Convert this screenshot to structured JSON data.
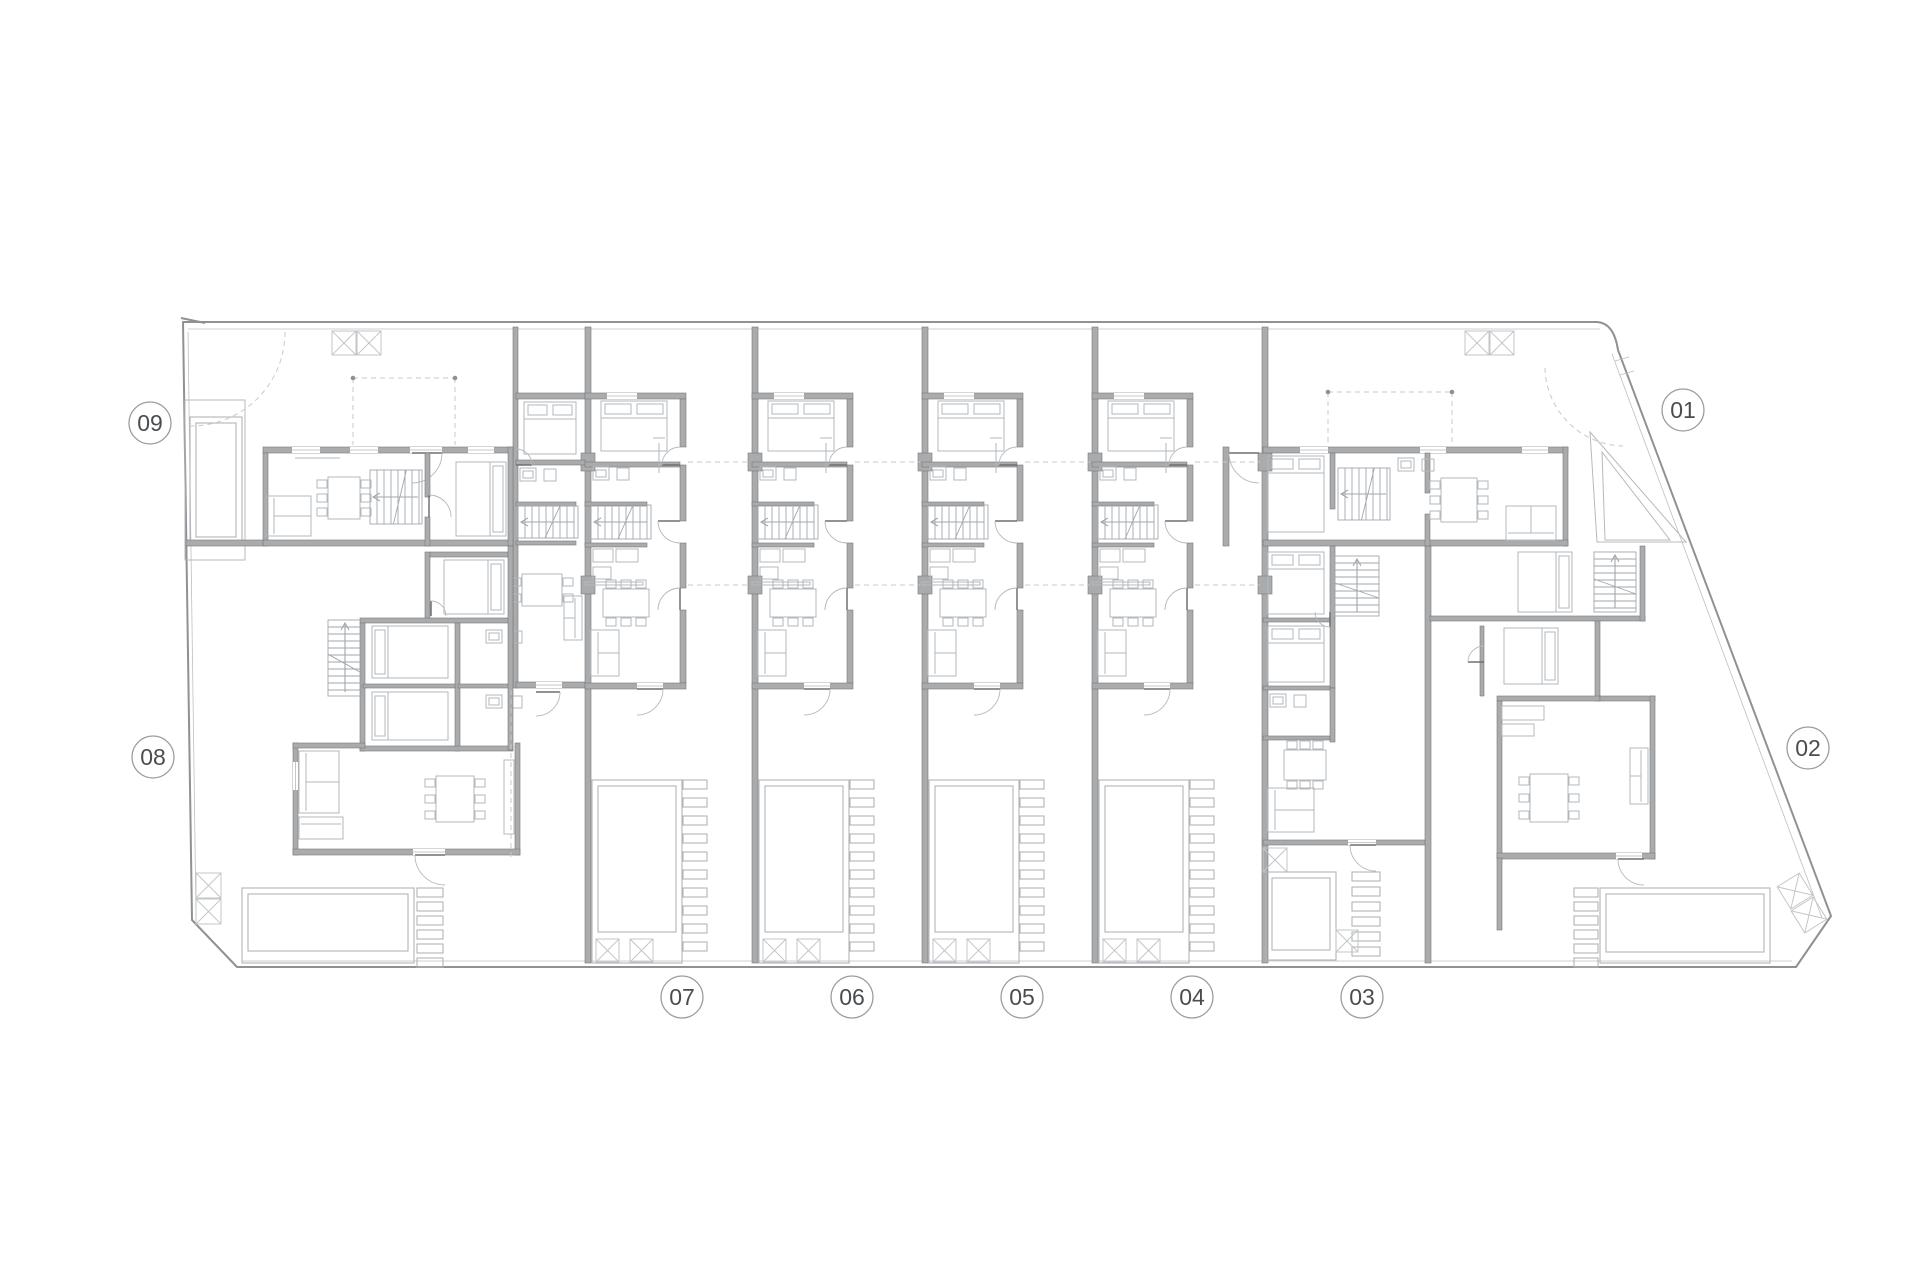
{
  "meta": {
    "sheet_name": "residential-site-floor-plan"
  },
  "colors": {
    "bg": "#ffffff",
    "wall_fill": "#a9abad",
    "wall_stroke": "#77797b",
    "thin": "#b6b9bc",
    "furn": "#b3b8bd",
    "stair": "#a2a7ac",
    "pool": "#b0b4b8",
    "xbox": "#c3c6c9",
    "boundary": "#8f9194",
    "boundary_inner": "#bcbfc2",
    "dash": "#c6c9cc",
    "door_leaf": "#6d7073",
    "label_ring": "#9a9da0",
    "label_text": "#4a4d50"
  },
  "canvas": {
    "w": 1920,
    "h": 1280
  },
  "unit_labels": [
    {
      "text": "09",
      "x": 150,
      "y": 423
    },
    {
      "text": "08",
      "x": 153,
      "y": 757
    },
    {
      "text": "07",
      "x": 682,
      "y": 997
    },
    {
      "text": "06",
      "x": 852,
      "y": 997
    },
    {
      "text": "05",
      "x": 1022,
      "y": 997
    },
    {
      "text": "04",
      "x": 1192,
      "y": 997
    },
    {
      "text": "03",
      "x": 1362,
      "y": 997
    },
    {
      "text": "02",
      "x": 1808,
      "y": 748
    },
    {
      "text": "01",
      "x": 1683,
      "y": 410
    }
  ],
  "boundary": {
    "main": "M183,322 L1597,322 Q1614,323 1618,350 L1831,916 L1796,967 L237,967 L192,920 Z",
    "inner": [
      [
        188,
        329,
        1600,
        329
      ],
      [
        1612,
        354,
        1822,
        918
      ],
      [
        242,
        961,
        1792,
        961
      ],
      [
        188,
        332,
        196,
        916
      ]
    ],
    "hook": "M181,318 l24,5",
    "gate_ticks": [
      [
        1615,
        361,
        1629,
        357
      ],
      [
        1620,
        375,
        1634,
        371
      ]
    ]
  },
  "global_elements": [
    [
      "wall",
      513,
      327,
      5,
      361
    ],
    [
      "wall",
      585,
      327,
      6,
      636
    ],
    [
      "wall",
      752,
      327,
      6,
      636
    ],
    [
      "wall",
      922,
      327,
      6,
      636
    ],
    [
      "wall",
      1092,
      327,
      6,
      636
    ],
    [
      "wall",
      1262,
      327,
      6,
      636
    ],
    [
      "wall",
      1425,
      546,
      6,
      417
    ],
    [
      "wall",
      581,
      453,
      14,
      18
    ],
    [
      "wall",
      581,
      576,
      14,
      18
    ],
    [
      "wall",
      748,
      453,
      14,
      18
    ],
    [
      "wall",
      748,
      576,
      14,
      18
    ],
    [
      "wall",
      918,
      453,
      14,
      18
    ],
    [
      "wall",
      918,
      576,
      14,
      18
    ],
    [
      "wall",
      1088,
      453,
      14,
      18
    ],
    [
      "wall",
      1088,
      576,
      14,
      18
    ],
    [
      "wall",
      1258,
      453,
      14,
      18
    ],
    [
      "wall",
      1258,
      576,
      14,
      18
    ],
    [
      "xbox",
      332,
      331,
      24,
      0
    ],
    [
      "xbox",
      357,
      331,
      24,
      0
    ],
    [
      "xbox",
      1465,
      331,
      24,
      0
    ],
    [
      "xbox",
      1490,
      331,
      24,
      0
    ],
    [
      "twall",
      185,
      400,
      60,
      160
    ],
    [
      "pool",
      190,
      417,
      52,
      126,
      6
    ],
    [
      "wall",
      263,
      447,
      250,
      6
    ],
    [
      "gap",
      292,
      447,
      28,
      6
    ],
    [
      "gap",
      350,
      447,
      28,
      6
    ],
    [
      "gap",
      468,
      447,
      26,
      6
    ],
    [
      "gap",
      410,
      447,
      32,
      6
    ],
    [
      "door",
      412,
      453,
      30,
      0,
      90
    ],
    [
      "wall",
      263,
      453,
      5,
      93
    ],
    [
      "wall",
      263,
      540,
      250,
      6
    ],
    [
      "wall",
      508,
      447,
      5,
      99
    ],
    [
      "wall",
      425,
      453,
      5,
      44
    ],
    [
      "wall",
      425,
      517,
      5,
      29
    ],
    [
      "door",
      429,
      517,
      22,
      270,
      0
    ],
    [
      "stairs",
      370,
      470,
      52,
      54,
      "h"
    ],
    [
      "sofa",
      267,
      496,
      44,
      40,
      "l"
    ],
    [
      "table",
      328,
      477,
      32,
      42,
      "v"
    ],
    [
      "bed",
      456,
      462,
      50,
      74,
      "r"
    ],
    [
      "line",
      295,
      458,
      340,
      458
    ],
    [
      "wall",
      516,
      393,
      69,
      6
    ],
    [
      "wall",
      516,
      460,
      69,
      5
    ],
    [
      "wall",
      516,
      502,
      60,
      4
    ],
    [
      "wall",
      516,
      541,
      60,
      4
    ],
    [
      "wall",
      516,
      682,
      69,
      6
    ],
    [
      "gap",
      536,
      682,
      26,
      6
    ],
    [
      "bed",
      524,
      402,
      52,
      52,
      "t"
    ],
    [
      "bath",
      520,
      468
    ],
    [
      "stairs",
      518,
      506,
      60,
      32,
      "h"
    ],
    [
      "table",
      522,
      574,
      40,
      32,
      "v"
    ],
    [
      "sofa",
      564,
      596,
      18,
      44,
      "r"
    ],
    [
      "door",
      536,
      692,
      24,
      0,
      90
    ],
    [
      "door",
      516,
      465,
      16,
      0,
      270
    ],
    [
      "wall",
      425,
      552,
      5,
      68
    ],
    [
      "wall",
      430,
      552,
      78,
      5
    ],
    [
      "bed",
      444,
      560,
      60,
      54,
      "r"
    ],
    [
      "wall",
      360,
      618,
      153,
      5
    ],
    [
      "wall",
      360,
      623,
      5,
      128
    ],
    [
      "wall",
      455,
      623,
      5,
      128
    ],
    [
      "wall",
      363,
      684,
      92,
      4
    ],
    [
      "wall",
      458,
      684,
      55,
      4
    ],
    [
      "wall",
      360,
      746,
      153,
      5
    ],
    [
      "bed",
      372,
      626,
      76,
      52,
      "l"
    ],
    [
      "bed",
      372,
      692,
      76,
      48,
      "l"
    ],
    [
      "bath",
      486,
      630
    ],
    [
      "bath",
      486,
      695
    ],
    [
      "stairs",
      328,
      620,
      34,
      76,
      "v"
    ],
    [
      "wall",
      508,
      546,
      5,
      204
    ],
    [
      "door",
      431,
      616,
      15,
      270,
      0
    ],
    [
      "wall",
      293,
      743,
      5,
      112
    ],
    [
      "wall",
      293,
      743,
      72,
      5
    ],
    [
      "wall",
      515,
      743,
      5,
      112
    ],
    [
      "wall",
      293,
      849,
      227,
      6
    ],
    [
      "gap",
      413,
      849,
      32,
      6
    ],
    [
      "door",
      445,
      855,
      30,
      180,
      90
    ],
    [
      "gap",
      293,
      762,
      5,
      28
    ],
    [
      "sofa",
      299,
      751,
      40,
      62,
      "l"
    ],
    [
      "sofa",
      299,
      817,
      44,
      22,
      "t"
    ],
    [
      "table",
      436,
      776,
      38,
      46,
      "v"
    ],
    [
      "twall",
      504,
      760,
      10,
      74
    ],
    [
      "wall",
      186,
      540,
      77,
      6
    ],
    [
      "pool",
      242,
      888,
      172,
      75,
      12
    ],
    [
      "stones",
      417,
      888,
      6,
      14,
      26,
      9
    ],
    [
      "xbox",
      196,
      873,
      25,
      0
    ],
    [
      "xbox",
      196,
      899,
      25,
      0
    ],
    [
      "dline",
      511,
      690,
      511,
      858
    ],
    [
      "wall",
      1263,
      447,
      305,
      6
    ],
    [
      "gap",
      1300,
      447,
      28,
      6
    ],
    [
      "gap",
      1420,
      447,
      26,
      6
    ],
    [
      "gap",
      1522,
      447,
      26,
      6
    ],
    [
      "wall",
      1223,
      447,
      6,
      99
    ],
    [
      "door",
      1259,
      453,
      30,
      180,
      90
    ],
    [
      "wall",
      1563,
      447,
      5,
      99
    ],
    [
      "wall",
      1263,
      540,
      305,
      6
    ],
    [
      "wall",
      1330,
      453,
      5,
      56
    ],
    [
      "wall",
      1425,
      453,
      5,
      40
    ],
    [
      "wall",
      1425,
      514,
      5,
      32
    ],
    [
      "bed",
      1268,
      456,
      56,
      76,
      "t"
    ],
    [
      "stairs",
      1338,
      468,
      52,
      52,
      "h"
    ],
    [
      "bath",
      1398,
      458
    ],
    [
      "table",
      1441,
      478,
      36,
      44,
      "v"
    ],
    [
      "sofa",
      1506,
      506,
      50,
      34,
      "b"
    ],
    [
      "path",
      "M1590,432 L1686,542 L1597,542 Z",
      "twall"
    ],
    [
      "path",
      "M1602,452 L1670,540 L1605,540 Z",
      "twall"
    ],
    [
      "wall",
      1330,
      546,
      5,
      142
    ],
    [
      "bed",
      1268,
      552,
      56,
      62,
      "t"
    ],
    [
      "wall",
      1263,
      618,
      67,
      4
    ],
    [
      "bed",
      1268,
      626,
      56,
      56,
      "t"
    ],
    [
      "wall",
      1263,
      686,
      67,
      4
    ],
    [
      "bath",
      1270,
      694
    ],
    [
      "wall",
      1263,
      736,
      67,
      4
    ],
    [
      "stairs",
      1335,
      556,
      44,
      60,
      "v"
    ],
    [
      "door",
      1330,
      612,
      15,
      90,
      180
    ],
    [
      "wall",
      1330,
      688,
      5,
      54
    ],
    [
      "table",
      1284,
      750,
      42,
      30,
      "h"
    ],
    [
      "sofa",
      1268,
      788,
      46,
      44,
      "l"
    ],
    [
      "wall",
      1263,
      840,
      162,
      5
    ],
    [
      "gap",
      1348,
      840,
      28,
      5
    ],
    [
      "door",
      1376,
      845,
      26,
      180,
      90
    ],
    [
      "xbox",
      1263,
      848,
      24,
      0
    ],
    [
      "pool",
      1266,
      872,
      70,
      88,
      10
    ],
    [
      "stones",
      1352,
      872,
      6,
      15,
      28,
      9
    ],
    [
      "xbox",
      1336,
      930,
      22,
      0
    ],
    [
      "wall",
      1430,
      616,
      215,
      5
    ],
    [
      "wall",
      1640,
      546,
      5,
      75
    ],
    [
      "bed",
      1518,
      552,
      54,
      60,
      "r"
    ],
    [
      "stairs",
      1594,
      552,
      42,
      60,
      "v"
    ],
    [
      "wall",
      1595,
      621,
      5,
      80
    ],
    [
      "bed",
      1504,
      628,
      54,
      56,
      "r"
    ],
    [
      "wall",
      1480,
      626,
      4,
      70
    ],
    [
      "door",
      1484,
      662,
      16,
      180,
      270
    ],
    [
      "wall",
      1497,
      696,
      103,
      5
    ],
    [
      "wall",
      1600,
      696,
      55,
      5
    ],
    [
      "wall",
      1497,
      701,
      5,
      157
    ],
    [
      "wall",
      1650,
      696,
      5,
      163
    ],
    [
      "wall",
      1497,
      853,
      158,
      6
    ],
    [
      "gap",
      1616,
      853,
      26,
      6
    ],
    [
      "door",
      1644,
      859,
      26,
      180,
      90
    ],
    [
      "table",
      1530,
      774,
      38,
      48,
      "v"
    ],
    [
      "sofa",
      1630,
      748,
      18,
      56,
      "r"
    ],
    [
      "twall",
      1502,
      706,
      42,
      14
    ],
    [
      "twall",
      1502,
      724,
      32,
      12
    ],
    [
      "wall",
      1497,
      858,
      5,
      72
    ],
    [
      "pool",
      1600,
      888,
      170,
      75,
      11
    ],
    [
      "stones",
      1574,
      888,
      6,
      14,
      24,
      9
    ],
    [
      "xbox",
      1782,
      878,
      26,
      -32
    ],
    [
      "xbox",
      1796,
      902,
      26,
      -32
    ],
    [
      "dline",
      688,
      462,
      750,
      462
    ],
    [
      "dline",
      688,
      585,
      750,
      585
    ],
    [
      "dline",
      855,
      462,
      920,
      462
    ],
    [
      "dline",
      855,
      585,
      920,
      585
    ],
    [
      "dline",
      1025,
      462,
      1090,
      462
    ],
    [
      "dline",
      1025,
      585,
      1090,
      585
    ],
    [
      "dline",
      1195,
      462,
      1260,
      462
    ],
    [
      "dline",
      1195,
      585,
      1260,
      585
    ],
    [
      "dline",
      353,
      378,
      455,
      378
    ],
    [
      "dline",
      353,
      378,
      353,
      445
    ],
    [
      "dline",
      455,
      378,
      455,
      445
    ],
    [
      "dot",
      353,
      378
    ],
    [
      "dot",
      455,
      378
    ],
    [
      "dline",
      1328,
      392,
      1452,
      392
    ],
    [
      "dline",
      1328,
      392,
      1328,
      445
    ],
    [
      "dline",
      1452,
      392,
      1452,
      445
    ],
    [
      "dot",
      1328,
      392
    ],
    [
      "dot",
      1452,
      392
    ],
    [
      "dpath",
      "M285,332 A94,94 0 0 1 191,426"
    ],
    [
      "dpath",
      "M1545,368 A80,80 0 0 0 1623,446"
    ]
  ],
  "townhouse": {
    "lefts": [
      585,
      752,
      922,
      1092
    ],
    "top": 327,
    "elements": [
      [
        "wall",
        0,
        66,
        101,
        6
      ],
      [
        "gap",
        22,
        66,
        30,
        6
      ],
      [
        "wall",
        95,
        72,
        6,
        48
      ],
      [
        "wall",
        95,
        138,
        6,
        56
      ],
      [
        "wall",
        95,
        216,
        6,
        45
      ],
      [
        "wall",
        95,
        283,
        6,
        73
      ],
      [
        "wall",
        0,
        135,
        95,
        5
      ],
      [
        "wall",
        0,
        175,
        62,
        4
      ],
      [
        "wall",
        0,
        216,
        62,
        4
      ],
      [
        "twall",
        0,
        255,
        58,
        3
      ],
      [
        "wall",
        0,
        356,
        101,
        6
      ],
      [
        "gap",
        52,
        356,
        26,
        6
      ],
      [
        "bed",
        16,
        74,
        66,
        50,
        "t"
      ],
      [
        "bath",
        8,
        140
      ],
      [
        "line",
        74,
        116,
        74,
        146
      ],
      [
        "line",
        68,
        111,
        80,
        111
      ],
      [
        "stairs",
        6,
        178,
        60,
        34,
        "h"
      ],
      [
        "twall",
        8,
        222,
        20,
        13
      ],
      [
        "twall",
        31,
        222,
        22,
        13
      ],
      [
        "twall",
        8,
        240,
        18,
        12
      ],
      [
        "table",
        18,
        262,
        46,
        28,
        "h"
      ],
      [
        "sofa",
        6,
        303,
        28,
        46,
        "l"
      ],
      [
        "door",
        95,
        138,
        18,
        180,
        270
      ],
      [
        "door",
        95,
        194,
        22,
        180,
        90
      ],
      [
        "door",
        95,
        283,
        22,
        270,
        180
      ],
      [
        "door",
        52,
        362,
        26,
        0,
        90
      ],
      [
        "pool",
        7,
        453,
        90,
        183,
        31
      ],
      [
        "stones",
        98,
        453,
        10,
        18,
        24,
        9
      ],
      [
        "xbox",
        11,
        612,
        23,
        0
      ],
      [
        "xbox",
        45,
        612,
        23,
        0
      ]
    ]
  }
}
